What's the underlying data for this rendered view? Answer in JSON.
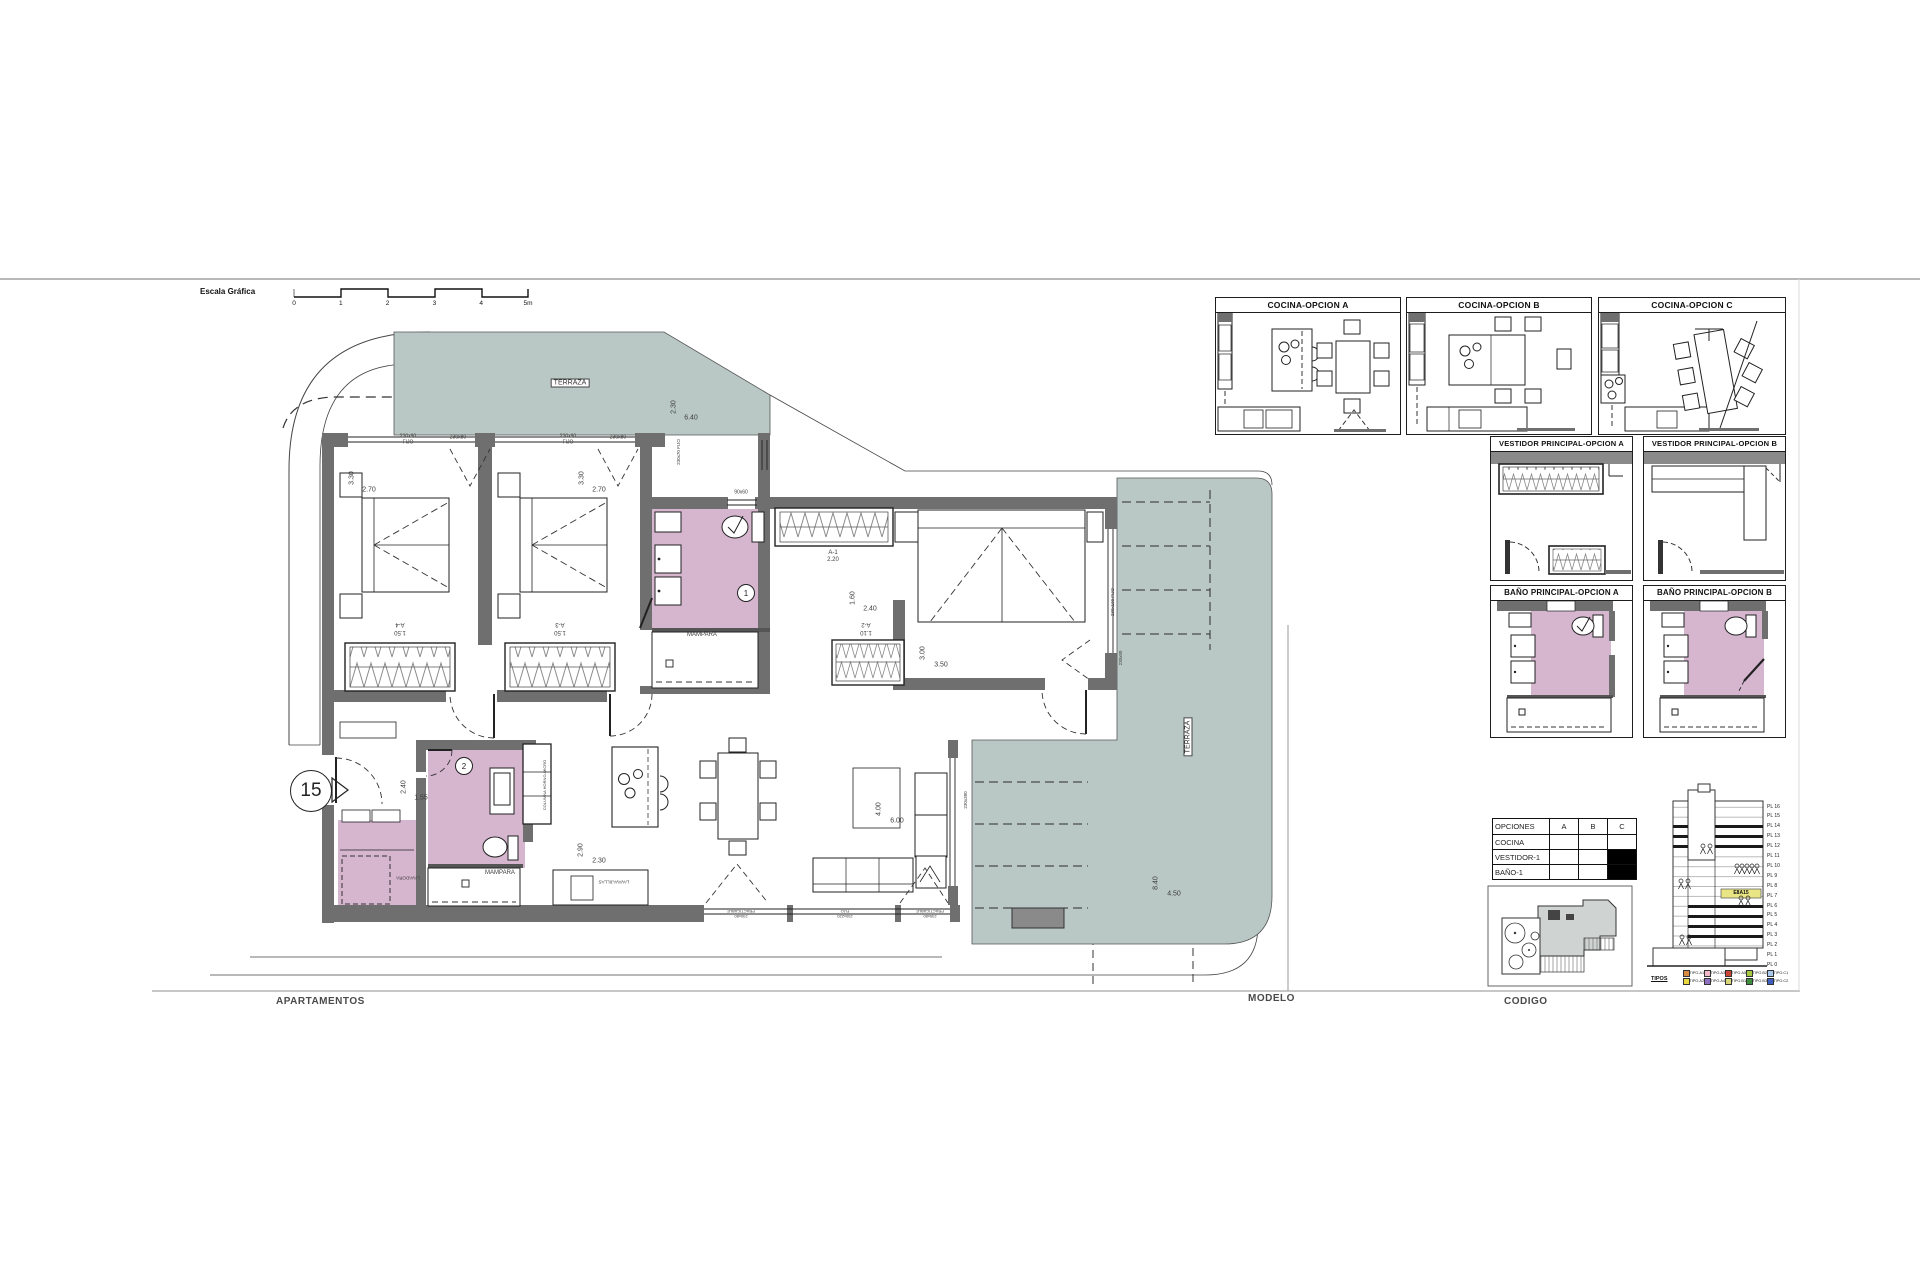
{
  "colors": {
    "teal": "#b9c8c5",
    "pink": "#d6b5cf",
    "wall": "#6f6f6f",
    "highlight": "#eae584"
  },
  "scale_bar": {
    "label": "Escala Gráfica",
    "ticks": [
      "0",
      "1",
      "2",
      "3",
      "4",
      "5m"
    ]
  },
  "footer": {
    "col1": "APARTAMENTOS",
    "col2": "MODELO",
    "col3": "CODIGO"
  },
  "unit_marker": "15",
  "panels": {
    "cocina_a": "COCINA-OPCION A",
    "cocina_b": "COCINA-OPCION B",
    "cocina_c": "COCINA-OPCION C",
    "vestidor_a": "VESTIDOR PRINCIPAL-OPCION A",
    "vestidor_b": "VESTIDOR PRINCIPAL-OPCION B",
    "bano_a": "BAÑO PRINCIPAL-OPCION A",
    "bano_b": "BAÑO PRINCIPAL-OPCION B"
  },
  "options_table": {
    "headers": [
      "OPCIONES",
      "A",
      "B",
      "C"
    ],
    "rows": [
      {
        "label": "COCINA",
        "cells": [
          "",
          "",
          ""
        ]
      },
      {
        "label": "VESTIDOR-1",
        "cells": [
          "",
          "",
          "X"
        ]
      },
      {
        "label": "BAÑO-1",
        "cells": [
          "",
          "",
          "X"
        ]
      }
    ]
  },
  "stack": {
    "floors": [
      "PL 16",
      "PL 15",
      "PL 14",
      "PL 13",
      "PL 12",
      "PL 11",
      "PL 10",
      "PL 9",
      "PL 8",
      "PL 7",
      "PL 6",
      "PL 5",
      "PL 4",
      "PL 3",
      "PL 2",
      "PL 1",
      "PL 0"
    ],
    "unit_label": "E8A15",
    "legend_title": "TIPOS",
    "legend_row1": [
      {
        "label": "TIPO.A1",
        "color": "#d98c3f"
      },
      {
        "label": "TIPO.A3",
        "color": "#f0b8c8"
      },
      {
        "label": "TIPO.A5",
        "color": "#cc4433"
      },
      {
        "label": "TIPO.B2",
        "color": "#a8c83f"
      },
      {
        "label": "TIPO.C1",
        "color": "#a8c8ee"
      }
    ],
    "legend_row2": [
      {
        "label": "TIPO.A2",
        "color": "#ead83f"
      },
      {
        "label": "TIPO.A4",
        "color": "#8f6fc0"
      },
      {
        "label": "TIPO.B1",
        "color": "#d8d87a"
      },
      {
        "label": "TIPO.B3",
        "color": "#3f8f3f"
      },
      {
        "label": "TIPO.C2",
        "color": "#3f5fc0"
      }
    ]
  },
  "room_numbers": [
    {
      "t": "1",
      "x": 745,
      "y": 592
    },
    {
      "t": "2",
      "x": 463,
      "y": 765
    }
  ],
  "plan_labels": [
    {
      "t": "TERRAZA",
      "x": 570,
      "y": 383,
      "s": 7,
      "box": true
    },
    {
      "t": "TERRAZA",
      "x": 1188,
      "y": 737,
      "s": 7,
      "box": true,
      "r": -90
    },
    {
      "t": "2.30",
      "x": 674,
      "y": 407,
      "s": 7,
      "r": -90
    },
    {
      "t": "6.40",
      "x": 691,
      "y": 418,
      "s": 7
    },
    {
      "t": "3.30",
      "x": 352,
      "y": 478,
      "s": 7,
      "r": -90
    },
    {
      "t": "2.70",
      "x": 369,
      "y": 490,
      "s": 7
    },
    {
      "t": "3.30",
      "x": 582,
      "y": 478,
      "s": 7,
      "r": -90
    },
    {
      "t": "2.70",
      "x": 599,
      "y": 490,
      "s": 7
    },
    {
      "t": "230x90",
      "x": 408,
      "y": 437,
      "s": 5
    },
    {
      "t": "FIJO",
      "x": 408,
      "y": 443,
      "s": 5
    },
    {
      "t": "230x80",
      "x": 458,
      "y": 438,
      "s": 5
    },
    {
      "t": "230x90",
      "x": 568,
      "y": 437,
      "s": 5
    },
    {
      "t": "FIJO",
      "x": 568,
      "y": 443,
      "s": 5
    },
    {
      "t": "230x80",
      "x": 618,
      "y": 438,
      "s": 5
    },
    {
      "t": "230x70 FIJO",
      "x": 679,
      "y": 452,
      "s": 4.5,
      "r": -90
    },
    {
      "t": "90x60",
      "x": 741,
      "y": 493,
      "s": 5
    },
    {
      "t": "A-4",
      "x": 400,
      "y": 624,
      "s": 6,
      "r": 180
    },
    {
      "t": "1.50",
      "x": 400,
      "y": 632,
      "s": 6,
      "r": 180
    },
    {
      "t": "A-3",
      "x": 560,
      "y": 624,
      "s": 6,
      "r": 180
    },
    {
      "t": "1.50",
      "x": 560,
      "y": 632,
      "s": 6,
      "r": 180
    },
    {
      "t": "MAMPARA",
      "x": 702,
      "y": 635,
      "s": 6
    },
    {
      "t": "A-1",
      "x": 833,
      "y": 553,
      "s": 6
    },
    {
      "t": "2.20",
      "x": 833,
      "y": 560,
      "s": 6
    },
    {
      "t": "1.60",
      "x": 853,
      "y": 598,
      "s": 7,
      "r": -90
    },
    {
      "t": "2.40",
      "x": 870,
      "y": 609,
      "s": 7
    },
    {
      "t": "A-2",
      "x": 866,
      "y": 624,
      "s": 6,
      "r": 180
    },
    {
      "t": "1.10",
      "x": 866,
      "y": 632,
      "s": 6,
      "r": 180
    },
    {
      "t": "3.00",
      "x": 923,
      "y": 653,
      "s": 7,
      "r": -90
    },
    {
      "t": "3.50",
      "x": 941,
      "y": 665,
      "s": 7
    },
    {
      "t": "230x190 FIJO",
      "x": 1113,
      "y": 602,
      "s": 4.5,
      "r": -90
    },
    {
      "t": "230x80",
      "x": 1121,
      "y": 658,
      "s": 4.5,
      "r": -90
    },
    {
      "t": "2.40",
      "x": 404,
      "y": 787,
      "s": 7,
      "r": -90
    },
    {
      "t": "1.55",
      "x": 421,
      "y": 798,
      "s": 7
    },
    {
      "t": "MAMPARA",
      "x": 500,
      "y": 873,
      "s": 6
    },
    {
      "t": "LAVADORA",
      "x": 408,
      "y": 877,
      "s": 4.5,
      "r": 180
    },
    {
      "t": "COLUMNA HORNO-MICRO",
      "x": 545,
      "y": 785,
      "s": 4,
      "r": -90
    },
    {
      "t": "2.90",
      "x": 581,
      "y": 850,
      "s": 7,
      "r": -90
    },
    {
      "t": "2.30",
      "x": 599,
      "y": 861,
      "s": 7
    },
    {
      "t": "LAVAVAJILLAS",
      "x": 614,
      "y": 881,
      "s": 4.5,
      "r": 180
    },
    {
      "t": "4.00",
      "x": 879,
      "y": 809,
      "s": 7,
      "r": -90
    },
    {
      "t": "6.00",
      "x": 897,
      "y": 821,
      "s": 7
    },
    {
      "t": "PRACTICABLE",
      "x": 741,
      "y": 911,
      "s": 4,
      "r": 180
    },
    {
      "t": "230x80",
      "x": 741,
      "y": 916,
      "s": 4,
      "r": 180
    },
    {
      "t": "FIJO",
      "x": 845,
      "y": 911,
      "s": 4,
      "r": 180
    },
    {
      "t": "230x220",
      "x": 845,
      "y": 916,
      "s": 4,
      "r": 180
    },
    {
      "t": "PRACTICABLE",
      "x": 930,
      "y": 911,
      "s": 4,
      "r": 180
    },
    {
      "t": "230x80",
      "x": 930,
      "y": 916,
      "s": 4,
      "r": 180
    },
    {
      "t": "230x380",
      "x": 966,
      "y": 800,
      "s": 4.5,
      "r": -90
    },
    {
      "t": "8.40",
      "x": 1156,
      "y": 883,
      "s": 7,
      "r": -90
    },
    {
      "t": "4.50",
      "x": 1174,
      "y": 894,
      "s": 7
    }
  ]
}
